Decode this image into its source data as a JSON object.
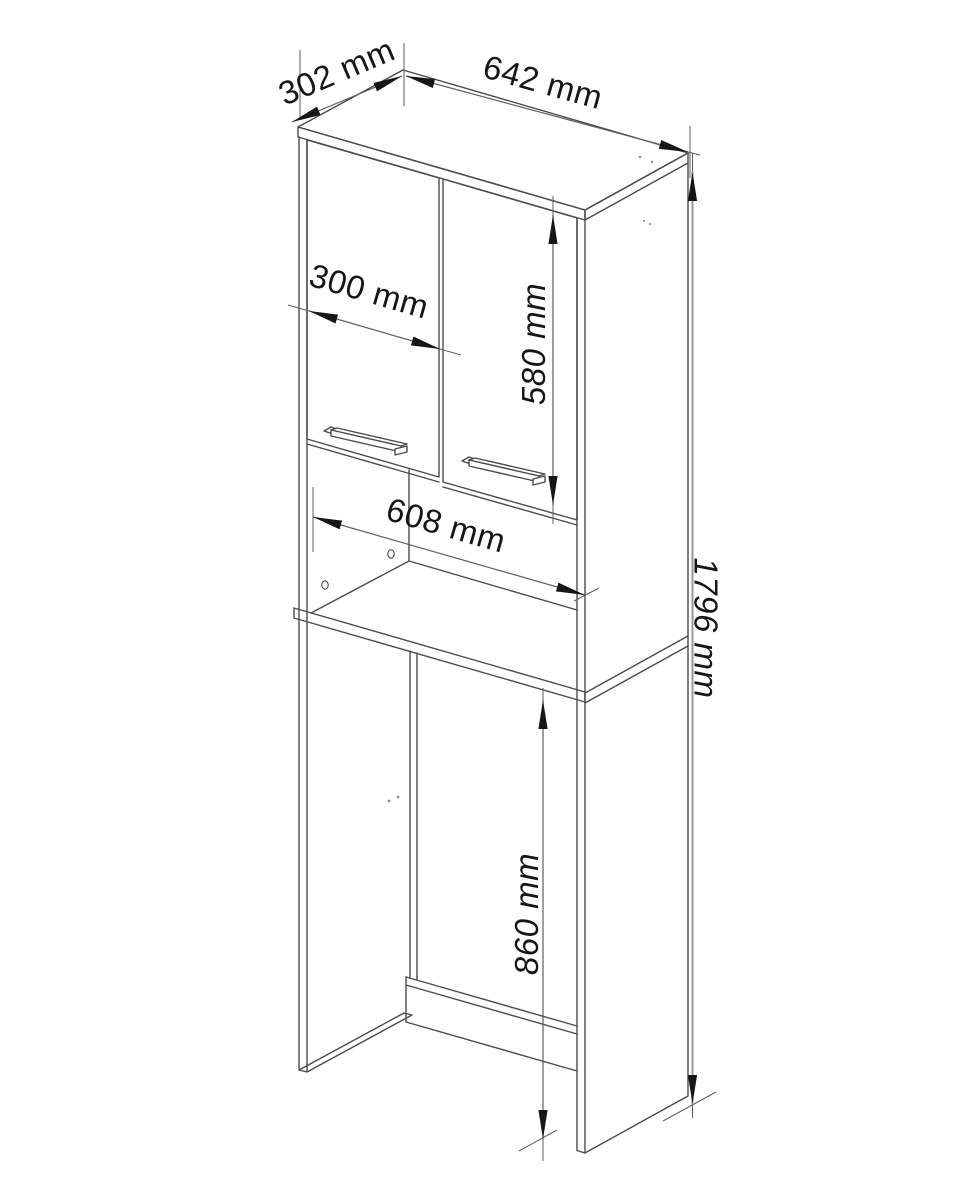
{
  "drawing": {
    "kind": "technical line drawing of a tall bathroom cabinet / washing machine surround, isometric view",
    "units": "mm",
    "colors": {
      "edges": "#4b4b4b",
      "dimension_lines": "#5f5f5f",
      "long_dimension_lines": "#979797",
      "arrows_text": "#161616",
      "background": "#ffffff"
    },
    "dims": {
      "depth": "302 mm",
      "top_width": "642 mm",
      "door_width": "300 mm",
      "door_height": "580 mm",
      "inner_width": "608 mm",
      "total_height": "1796 mm",
      "opening_height": "860 mm"
    }
  }
}
